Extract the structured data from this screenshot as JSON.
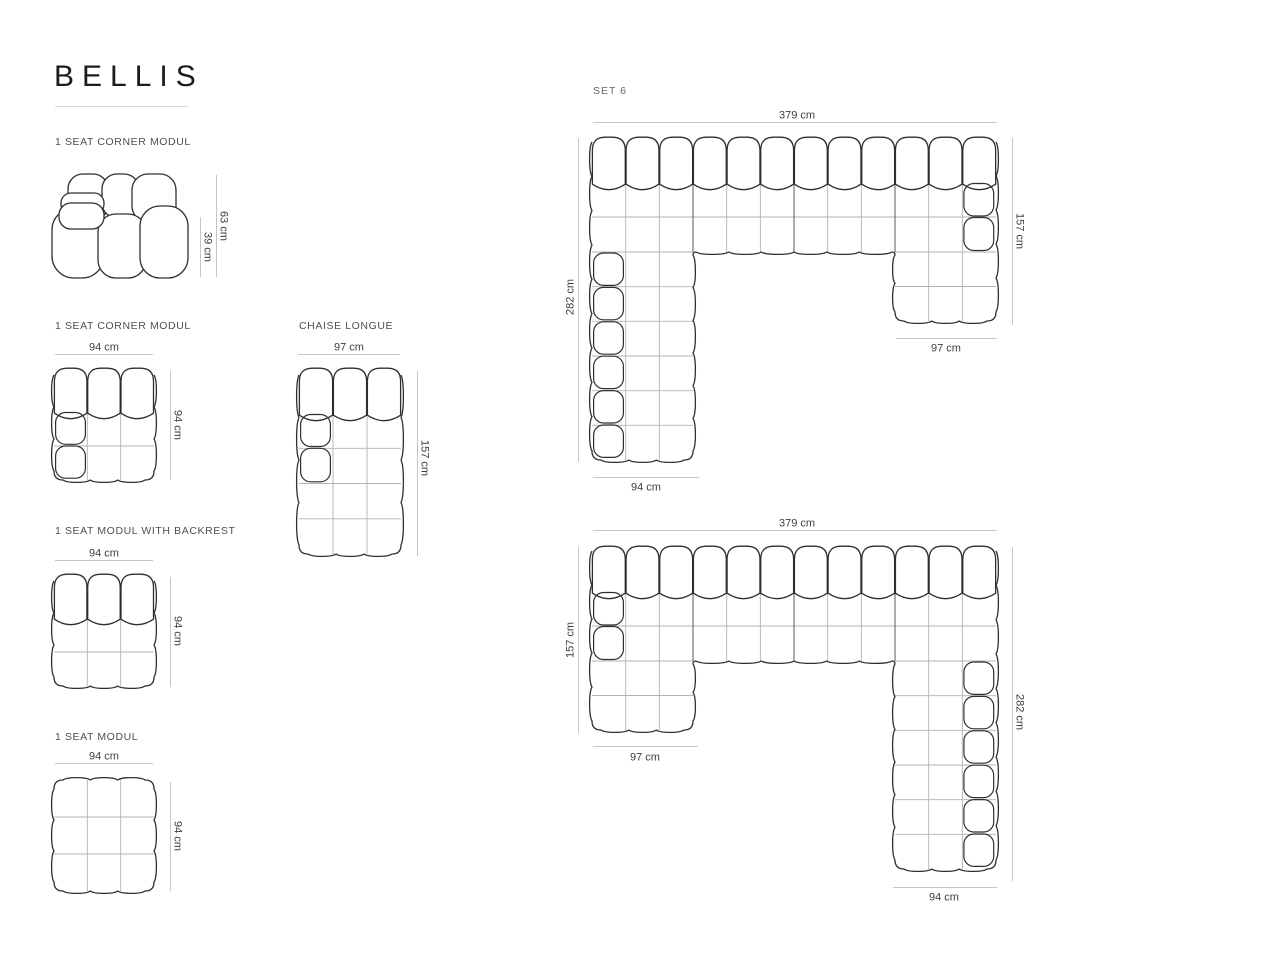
{
  "title": "BELLIS",
  "modules": {
    "corner_side": {
      "label": "1 SEAT CORNER MODUL",
      "dim_height": "63 cm",
      "dim_seat_height": "39 cm"
    },
    "corner_top": {
      "label": "1 SEAT CORNER MODUL",
      "dim_width": "94 cm",
      "dim_depth": "94 cm"
    },
    "chaise": {
      "label": "CHAISE LONGUE",
      "dim_width": "97 cm",
      "dim_depth": "157 cm"
    },
    "backrest_modul": {
      "label": "1 SEAT MODUL WITH BACKREST",
      "dim_width": "94 cm",
      "dim_depth": "94 cm"
    },
    "seat_modul": {
      "label": "1 SEAT MODUL",
      "dim_width": "94 cm",
      "dim_depth": "94 cm"
    }
  },
  "sets": {
    "set6": {
      "label": "SET 6",
      "dim_top": "379 cm",
      "dim_right": "157 cm",
      "dim_left": "282 cm",
      "dim_bottom_right": "97 cm",
      "dim_bottom_left": "94 cm"
    },
    "set_mirror": {
      "dim_top": "379 cm",
      "dim_left": "157 cm",
      "dim_bottom_left": "97 cm",
      "dim_right": "282 cm",
      "dim_bottom_right": "94 cm"
    }
  }
}
